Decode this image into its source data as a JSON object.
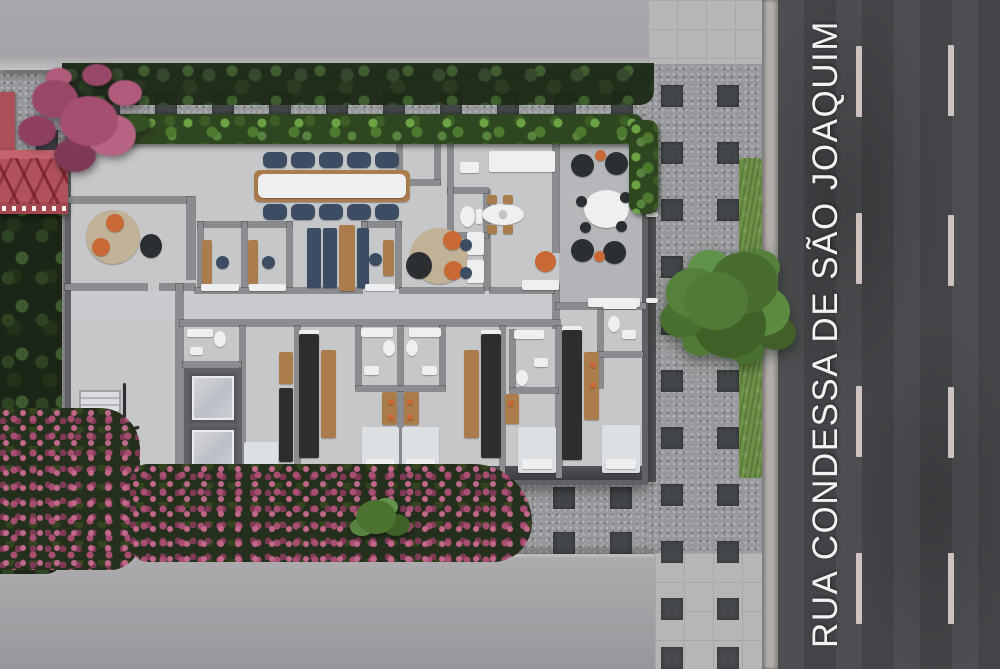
{
  "street": {
    "name": "RUA CONDESSA DE SÃO JOAQUIM",
    "dash_width": 6,
    "dash_height": 71,
    "dash_columns": [
      {
        "x": 856,
        "ys": [
          46,
          213,
          386,
          553
        ]
      },
      {
        "x": 948,
        "ys": [
          45,
          215,
          387,
          553
        ]
      }
    ]
  },
  "paving_squares": {
    "size": 22,
    "groups": [
      {
        "name": "sidewalk-paver",
        "cols_x": [
          661,
          717
        ],
        "rows_y": [
          85,
          142,
          199,
          256,
          313,
          370,
          427,
          484,
          541,
          598,
          647
        ]
      },
      {
        "name": "courtyard-paver",
        "cols_x": [
          98,
          155,
          212,
          269,
          326,
          383,
          440,
          497,
          554,
          611
        ],
        "rows_y": [
          92
        ]
      },
      {
        "name": "bottomband-paver",
        "cols_x": [
          211,
          268,
          325,
          382,
          439,
          496,
          553,
          610
        ],
        "rows_y": [
          487,
          532
        ]
      },
      {
        "name": "leftmargin-paver",
        "cols_x": [
          36
        ],
        "rows_y": [
          130,
          246,
          362,
          478
        ]
      }
    ]
  },
  "palette": {
    "asphalt": "#46484b",
    "street_text": "#f2f2f4",
    "lane_dash": "#d5c9c6",
    "mosaic_dark": "#383b3e",
    "floor": "#c6c7c9",
    "wall": "#8a8c8f",
    "wall_dark": "#5f6164",
    "grass": "#6d9147",
    "pink": "#a84e72",
    "pink_light": "#c2688c",
    "wood": "#ab7c4c",
    "orange": "#c96a36",
    "navy": "#3c4d63",
    "rug": "#c0b197",
    "white_furn": "#eeeff0",
    "bed": "#dde0e2",
    "dark_furn": "#2c2f32",
    "kitchen_dark": "#2b2d2f",
    "steel": "#c2c3c5"
  },
  "furniture": [
    {
      "n": "round-rug",
      "x": 86,
      "y": 210,
      "w": 54,
      "h": 54,
      "s": "circle",
      "c": "rug"
    },
    {
      "n": "orange-armchair",
      "x": 106,
      "y": 214,
      "w": 18,
      "h": 18,
      "s": "circle",
      "c": "orange"
    },
    {
      "n": "orange-armchair",
      "x": 92,
      "y": 238,
      "w": 18,
      "h": 18,
      "s": "circle",
      "c": "orange"
    },
    {
      "n": "floor-lamp",
      "x": 140,
      "y": 234,
      "w": 22,
      "h": 24,
      "s": "circle",
      "c": "dark_furn"
    },
    {
      "n": "booth-desk",
      "x": 202,
      "y": 240,
      "w": 10,
      "h": 44,
      "c": "wood"
    },
    {
      "n": "office-chair",
      "x": 216,
      "y": 256,
      "w": 13,
      "h": 13,
      "s": "circle",
      "c": "navy"
    },
    {
      "n": "booth-desk",
      "x": 248,
      "y": 240,
      "w": 10,
      "h": 44,
      "c": "wood"
    },
    {
      "n": "office-chair",
      "x": 262,
      "y": 256,
      "w": 13,
      "h": 13,
      "s": "circle",
      "c": "navy"
    },
    {
      "n": "door-threshold",
      "x": 201,
      "y": 284,
      "w": 38,
      "h": 7,
      "c": "white_furn"
    },
    {
      "n": "door-threshold",
      "x": 249,
      "y": 284,
      "w": 37,
      "h": 7,
      "c": "white_furn"
    },
    {
      "n": "conference-table",
      "x": 254,
      "y": 170,
      "w": 156,
      "h": 32,
      "s": "pill",
      "c": "wood"
    },
    {
      "n": "conference-tabletop",
      "x": 258,
      "y": 174,
      "w": 148,
      "h": 24,
      "s": "pill",
      "c": "white_furn"
    },
    {
      "n": "conference-chair",
      "x": 263,
      "y": 152,
      "w": 24,
      "h": 16,
      "s": "pill",
      "c": "navy"
    },
    {
      "n": "conference-chair",
      "x": 291,
      "y": 152,
      "w": 24,
      "h": 16,
      "s": "pill",
      "c": "navy"
    },
    {
      "n": "conference-chair",
      "x": 319,
      "y": 152,
      "w": 24,
      "h": 16,
      "s": "pill",
      "c": "navy"
    },
    {
      "n": "conference-chair",
      "x": 347,
      "y": 152,
      "w": 24,
      "h": 16,
      "s": "pill",
      "c": "navy"
    },
    {
      "n": "conference-chair",
      "x": 375,
      "y": 152,
      "w": 24,
      "h": 16,
      "s": "pill",
      "c": "navy"
    },
    {
      "n": "conference-chair",
      "x": 263,
      "y": 204,
      "w": 24,
      "h": 16,
      "s": "pill",
      "c": "navy"
    },
    {
      "n": "conference-chair",
      "x": 291,
      "y": 204,
      "w": 24,
      "h": 16,
      "s": "pill",
      "c": "navy"
    },
    {
      "n": "conference-chair",
      "x": 319,
      "y": 204,
      "w": 24,
      "h": 16,
      "s": "pill",
      "c": "navy"
    },
    {
      "n": "conference-chair",
      "x": 347,
      "y": 204,
      "w": 24,
      "h": 16,
      "s": "pill",
      "c": "navy"
    },
    {
      "n": "conference-chair",
      "x": 375,
      "y": 204,
      "w": 24,
      "h": 16,
      "s": "pill",
      "c": "navy"
    },
    {
      "n": "banquette-sofa",
      "x": 307,
      "y": 228,
      "w": 14,
      "h": 60,
      "c": "navy"
    },
    {
      "n": "banquette-sofa",
      "x": 323,
      "y": 228,
      "w": 14,
      "h": 60,
      "c": "navy"
    },
    {
      "n": "banquette-table",
      "x": 339,
      "y": 225,
      "w": 16,
      "h": 66,
      "c": "wood"
    },
    {
      "n": "banquette-sofa",
      "x": 357,
      "y": 228,
      "w": 12,
      "h": 60,
      "c": "navy"
    },
    {
      "n": "booth-desk",
      "x": 383,
      "y": 240,
      "w": 11,
      "h": 36,
      "c": "wood"
    },
    {
      "n": "office-chair",
      "x": 369,
      "y": 253,
      "w": 13,
      "h": 13,
      "s": "circle",
      "c": "navy"
    },
    {
      "n": "door-threshold",
      "x": 365,
      "y": 284,
      "w": 30,
      "h": 7,
      "c": "white_furn"
    },
    {
      "n": "round-rug",
      "x": 410,
      "y": 228,
      "w": 58,
      "h": 56,
      "s": "circle",
      "c": "rug"
    },
    {
      "n": "orange-armchair",
      "x": 443,
      "y": 231,
      "w": 19,
      "h": 19,
      "s": "circle",
      "c": "orange"
    },
    {
      "n": "orange-armchair",
      "x": 444,
      "y": 261,
      "w": 19,
      "h": 19,
      "s": "circle",
      "c": "orange"
    },
    {
      "n": "lounge-sofa",
      "x": 406,
      "y": 252,
      "w": 26,
      "h": 27,
      "s": "circle",
      "c": "dark_furn"
    },
    {
      "n": "work-desk",
      "x": 467,
      "y": 232,
      "w": 17,
      "h": 23,
      "c": "white_furn"
    },
    {
      "n": "office-chair",
      "x": 460,
      "y": 239,
      "w": 12,
      "h": 12,
      "s": "circle",
      "c": "navy"
    },
    {
      "n": "work-desk",
      "x": 467,
      "y": 260,
      "w": 17,
      "h": 23,
      "c": "white_furn"
    },
    {
      "n": "office-chair",
      "x": 460,
      "y": 267,
      "w": 12,
      "h": 12,
      "s": "circle",
      "c": "navy"
    },
    {
      "n": "toilet",
      "x": 460,
      "y": 206,
      "w": 15,
      "h": 21,
      "s": "circle",
      "c": "white_furn"
    },
    {
      "n": "toilet-tank",
      "x": 476,
      "y": 209,
      "w": 6,
      "h": 15,
      "c": "white_furn"
    },
    {
      "n": "kitchen-counter",
      "x": 489,
      "y": 151,
      "w": 66,
      "h": 21,
      "c": "white_furn"
    },
    {
      "n": "kitchen-appliance",
      "x": 460,
      "y": 162,
      "w": 19,
      "h": 11,
      "c": "white_furn"
    },
    {
      "n": "dining-table",
      "x": 482,
      "y": 204,
      "w": 42,
      "h": 21,
      "s": "circle",
      "c": "white_furn"
    },
    {
      "n": "dining-chair",
      "x": 487,
      "y": 195,
      "w": 10,
      "h": 9,
      "c": "wood"
    },
    {
      "n": "dining-chair",
      "x": 503,
      "y": 195,
      "w": 10,
      "h": 9,
      "c": "wood"
    },
    {
      "n": "dining-chair",
      "x": 487,
      "y": 225,
      "w": 10,
      "h": 9,
      "c": "wood"
    },
    {
      "n": "dining-chair",
      "x": 503,
      "y": 225,
      "w": 10,
      "h": 9,
      "c": "wood"
    },
    {
      "n": "table-vase",
      "x": 499,
      "y": 210,
      "w": 8,
      "h": 8,
      "s": "circle",
      "c": "steel"
    },
    {
      "n": "orange-armchair",
      "x": 535,
      "y": 251,
      "w": 21,
      "h": 21,
      "s": "circle",
      "c": "orange"
    },
    {
      "n": "bench",
      "x": 522,
      "y": 280,
      "w": 37,
      "h": 10,
      "c": "white_furn"
    },
    {
      "n": "terrace-lounge-chair",
      "x": 571,
      "y": 154,
      "w": 23,
      "h": 23,
      "s": "circle",
      "c": "dark_furn"
    },
    {
      "n": "terrace-lounge-chair",
      "x": 605,
      "y": 152,
      "w": 23,
      "h": 23,
      "s": "circle",
      "c": "dark_furn"
    },
    {
      "n": "terrace-side-table",
      "x": 595,
      "y": 150,
      "w": 11,
      "h": 11,
      "s": "circle",
      "c": "orange"
    },
    {
      "n": "terrace-lounge-chair",
      "x": 571,
      "y": 239,
      "w": 23,
      "h": 23,
      "s": "circle",
      "c": "dark_furn"
    },
    {
      "n": "terrace-lounge-chair",
      "x": 603,
      "y": 241,
      "w": 23,
      "h": 23,
      "s": "circle",
      "c": "dark_furn"
    },
    {
      "n": "terrace-side-table",
      "x": 594,
      "y": 251,
      "w": 11,
      "h": 11,
      "s": "circle",
      "c": "orange"
    },
    {
      "n": "terrace-table",
      "x": 584,
      "y": 190,
      "w": 45,
      "h": 38,
      "s": "circle",
      "c": "white_furn"
    },
    {
      "n": "terrace-chair",
      "x": 576,
      "y": 196,
      "w": 11,
      "h": 11,
      "s": "circle",
      "c": "dark_furn"
    },
    {
      "n": "terrace-chair",
      "x": 620,
      "y": 192,
      "w": 11,
      "h": 11,
      "s": "circle",
      "c": "dark_furn"
    },
    {
      "n": "terrace-chair",
      "x": 580,
      "y": 222,
      "w": 11,
      "h": 11,
      "s": "circle",
      "c": "dark_furn"
    },
    {
      "n": "terrace-chair",
      "x": 616,
      "y": 221,
      "w": 11,
      "h": 11,
      "s": "circle",
      "c": "dark_furn"
    },
    {
      "n": "planter-bench",
      "x": 588,
      "y": 298,
      "w": 52,
      "h": 9,
      "c": "white_furn"
    },
    {
      "n": "roof-vent",
      "x": 646,
      "y": 212,
      "w": 12,
      "h": 5,
      "c": "white_furn"
    },
    {
      "n": "roof-vent",
      "x": 646,
      "y": 298,
      "w": 12,
      "h": 5,
      "c": "white_furn"
    },
    {
      "n": "stair-railing",
      "x": 123,
      "y": 383,
      "w": 3,
      "h": 54,
      "c": "dark_furn"
    },
    {
      "n": "stair-railing-bar",
      "x": 110,
      "y": 430,
      "w": 30,
      "h": 3,
      "c": "dark_furn",
      "r": -18
    },
    {
      "n": "shower-bench",
      "x": 187,
      "y": 329,
      "w": 26,
      "h": 8,
      "c": "white_furn"
    },
    {
      "n": "toilet",
      "x": 214,
      "y": 331,
      "w": 12,
      "h": 16,
      "s": "circle",
      "c": "white_furn"
    },
    {
      "n": "bath-sink",
      "x": 190,
      "y": 347,
      "w": 13,
      "h": 8,
      "c": "white_furn"
    },
    {
      "n": "bed",
      "x": 244,
      "y": 442,
      "w": 34,
      "h": 32,
      "c": "bed"
    },
    {
      "n": "kitchenette",
      "x": 279,
      "y": 388,
      "w": 14,
      "h": 74,
      "c": "kitchen_dark"
    },
    {
      "n": "kitchenette-shelf",
      "x": 279,
      "y": 352,
      "w": 14,
      "h": 32,
      "c": "wood"
    },
    {
      "n": "kitchenette-fridge",
      "x": 299,
      "y": 330,
      "w": 20,
      "h": 14,
      "c": "white_furn"
    },
    {
      "n": "kitchenette",
      "x": 299,
      "y": 334,
      "w": 20,
      "h": 124,
      "c": "kitchen_dark"
    },
    {
      "n": "kitchenette-shelf",
      "x": 321,
      "y": 350,
      "w": 15,
      "h": 88,
      "c": "wood"
    },
    {
      "n": "shower-bench",
      "x": 361,
      "y": 328,
      "w": 32,
      "h": 9,
      "c": "white_furn"
    },
    {
      "n": "toilet",
      "x": 383,
      "y": 340,
      "w": 12,
      "h": 16,
      "s": "circle",
      "c": "white_furn"
    },
    {
      "n": "bath-sink",
      "x": 364,
      "y": 366,
      "w": 15,
      "h": 9,
      "c": "white_furn"
    },
    {
      "n": "unit-desk",
      "x": 382,
      "y": 392,
      "w": 15,
      "h": 33,
      "c": "wood"
    },
    {
      "n": "desk-lamp",
      "x": 388,
      "y": 399,
      "w": 6,
      "h": 6,
      "s": "circle",
      "c": "orange"
    },
    {
      "n": "desk-lamp",
      "x": 388,
      "y": 414,
      "w": 6,
      "h": 6,
      "s": "circle",
      "c": "orange"
    },
    {
      "n": "bed",
      "x": 362,
      "y": 427,
      "w": 37,
      "h": 46,
      "c": "bed"
    },
    {
      "n": "bed-pillow",
      "x": 366,
      "y": 459,
      "w": 29,
      "h": 10,
      "c": "white_furn"
    },
    {
      "n": "shower-bench",
      "x": 409,
      "y": 328,
      "w": 32,
      "h": 9,
      "c": "white_furn"
    },
    {
      "n": "toilet",
      "x": 406,
      "y": 340,
      "w": 12,
      "h": 16,
      "s": "circle",
      "c": "white_furn"
    },
    {
      "n": "bath-sink",
      "x": 422,
      "y": 366,
      "w": 15,
      "h": 9,
      "c": "white_furn"
    },
    {
      "n": "unit-desk",
      "x": 404,
      "y": 392,
      "w": 15,
      "h": 33,
      "c": "wood"
    },
    {
      "n": "desk-lamp",
      "x": 407,
      "y": 399,
      "w": 6,
      "h": 6,
      "s": "circle",
      "c": "orange"
    },
    {
      "n": "desk-lamp",
      "x": 407,
      "y": 414,
      "w": 6,
      "h": 6,
      "s": "circle",
      "c": "orange"
    },
    {
      "n": "bed",
      "x": 402,
      "y": 427,
      "w": 37,
      "h": 46,
      "c": "bed"
    },
    {
      "n": "bed-pillow",
      "x": 406,
      "y": 459,
      "w": 29,
      "h": 10,
      "c": "white_furn"
    },
    {
      "n": "kitchenette-shelf",
      "x": 464,
      "y": 350,
      "w": 15,
      "h": 88,
      "c": "wood"
    },
    {
      "n": "kitchenette-fridge",
      "x": 481,
      "y": 330,
      "w": 20,
      "h": 14,
      "c": "white_furn"
    },
    {
      "n": "kitchenette",
      "x": 481,
      "y": 334,
      "w": 20,
      "h": 124,
      "c": "kitchen_dark"
    },
    {
      "n": "shower-bench",
      "x": 514,
      "y": 330,
      "w": 30,
      "h": 9,
      "c": "white_furn"
    },
    {
      "n": "toilet",
      "x": 516,
      "y": 370,
      "w": 12,
      "h": 16,
      "s": "circle",
      "c": "white_furn"
    },
    {
      "n": "bath-sink",
      "x": 534,
      "y": 358,
      "w": 14,
      "h": 9,
      "c": "white_furn"
    },
    {
      "n": "unit-desk",
      "x": 505,
      "y": 394,
      "w": 14,
      "h": 30,
      "c": "wood"
    },
    {
      "n": "desk-lamp",
      "x": 508,
      "y": 400,
      "w": 6,
      "h": 6,
      "s": "circle",
      "c": "orange"
    },
    {
      "n": "bed",
      "x": 518,
      "y": 427,
      "w": 38,
      "h": 46,
      "c": "bed"
    },
    {
      "n": "bed-pillow",
      "x": 522,
      "y": 459,
      "w": 30,
      "h": 10,
      "c": "white_furn"
    },
    {
      "n": "kitchenette-fridge",
      "x": 562,
      "y": 326,
      "w": 20,
      "h": 14,
      "c": "white_furn"
    },
    {
      "n": "kitchenette",
      "x": 562,
      "y": 330,
      "w": 20,
      "h": 130,
      "c": "kitchen_dark"
    },
    {
      "n": "unit-desk",
      "x": 584,
      "y": 352,
      "w": 15,
      "h": 68,
      "c": "wood"
    },
    {
      "n": "desk-lamp",
      "x": 590,
      "y": 362,
      "w": 6,
      "h": 6,
      "s": "circle",
      "c": "orange"
    },
    {
      "n": "desk-lamp",
      "x": 590,
      "y": 382,
      "w": 6,
      "h": 6,
      "s": "circle",
      "c": "orange"
    },
    {
      "n": "shower-bench",
      "x": 603,
      "y": 300,
      "w": 34,
      "h": 9,
      "c": "white_furn"
    },
    {
      "n": "toilet",
      "x": 608,
      "y": 316,
      "w": 12,
      "h": 16,
      "s": "circle",
      "c": "white_furn"
    },
    {
      "n": "bath-sink",
      "x": 622,
      "y": 330,
      "w": 14,
      "h": 9,
      "c": "white_furn"
    },
    {
      "n": "bed",
      "x": 602,
      "y": 425,
      "w": 38,
      "h": 48,
      "c": "bed"
    },
    {
      "n": "bed-pillow",
      "x": 606,
      "y": 459,
      "w": 30,
      "h": 10,
      "c": "white_furn"
    }
  ]
}
